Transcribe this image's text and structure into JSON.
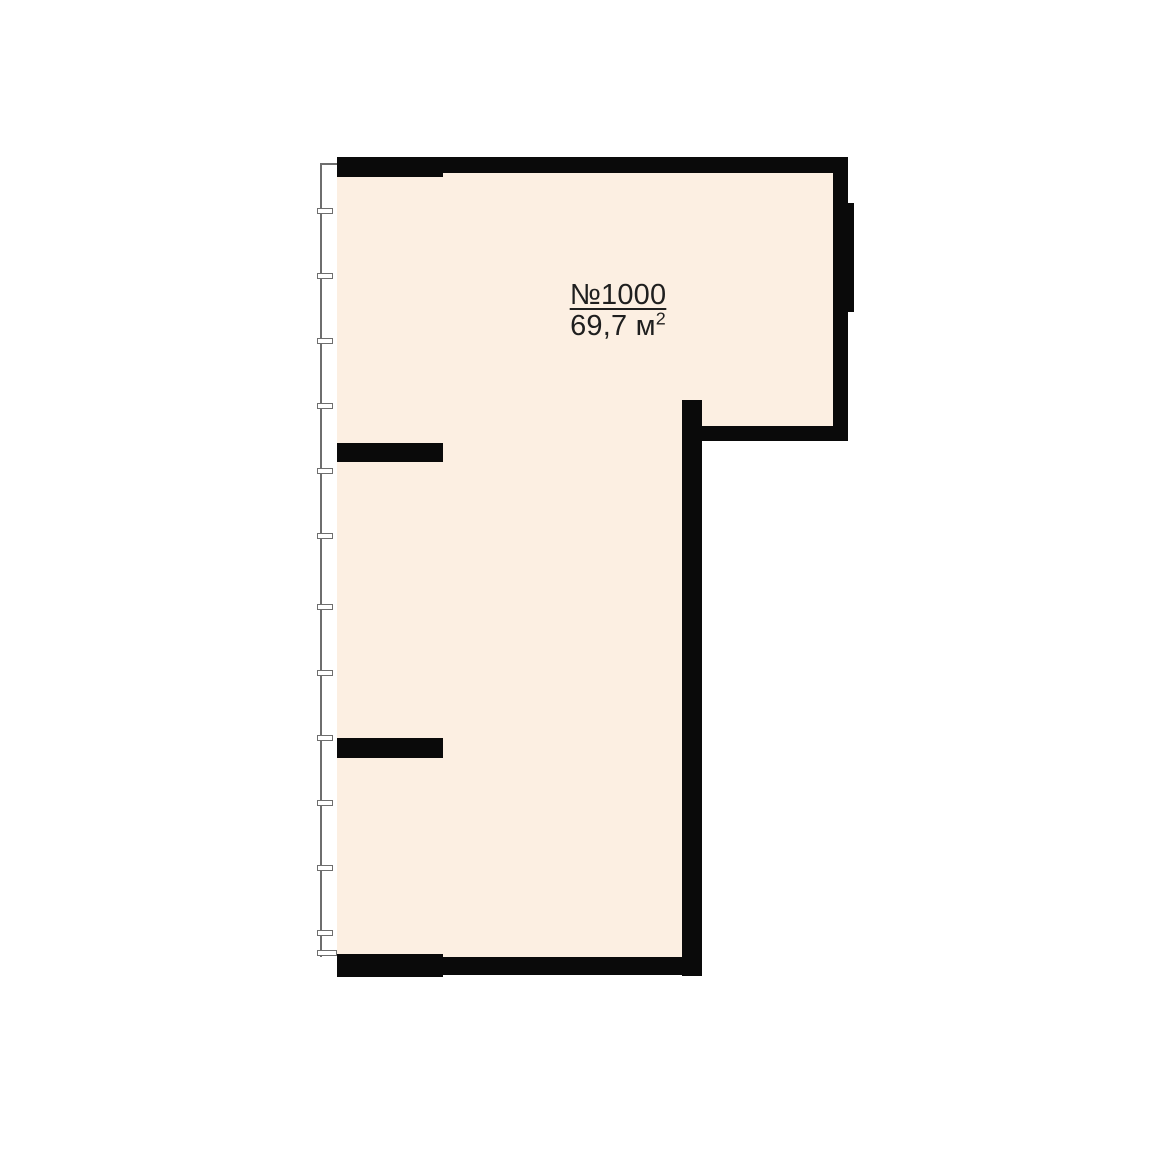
{
  "page": {
    "background_color": "#ffffff"
  },
  "floorplan": {
    "unit": {
      "number": "№1000",
      "area_value": "69,7 м",
      "area_superscript": "2"
    },
    "colors": {
      "floor_fill": "#fcefe2",
      "wall": "#0a0a0a",
      "glazing_line": "#6e6e6e",
      "tick_fill": "#ffffff",
      "label_text": "#1f1f1f"
    },
    "window_tick_count": 12
  }
}
